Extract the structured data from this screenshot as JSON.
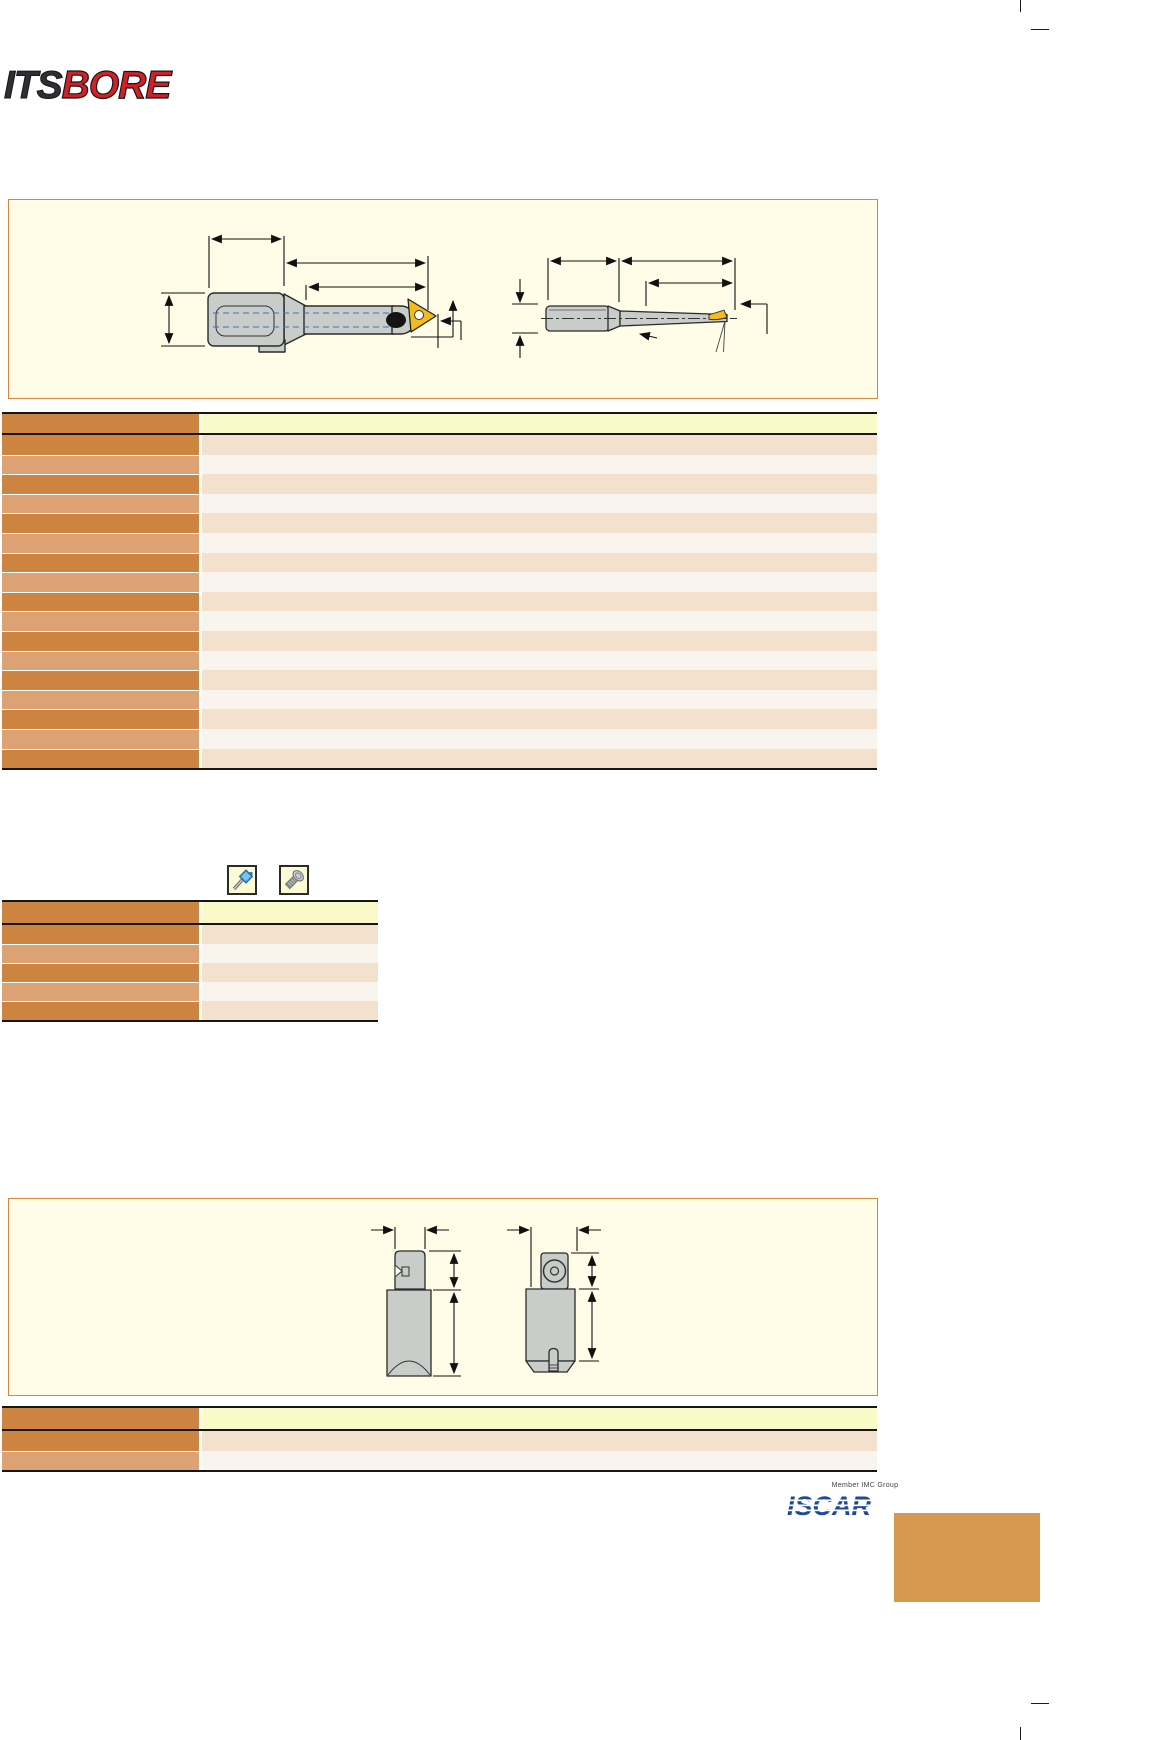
{
  "window": {
    "width": 1164,
    "height": 1740,
    "background": "#ffffff"
  },
  "logo": {
    "text_its": "ITS",
    "text_bore": "BORE",
    "color_its": "#2d2f34",
    "color_bore": "#d22027"
  },
  "diagram_box_1": {
    "background": "#fffde7",
    "border_color": "#d9863b",
    "drawings": [
      {
        "name": "boring-head-side-view"
      },
      {
        "name": "micro-boring-bar-side-view"
      }
    ],
    "steel_color": "#c9cdc9",
    "insert_color": "#f2bc1c",
    "centerline_color": "#3f6fbe"
  },
  "spec_table_1": {
    "columns": 2,
    "body_rows": 17,
    "header_left_color": "#cd8440",
    "header_right_color": "#faf9c8",
    "row_dark_color": "#cd8440",
    "row_light_color": "#dda273",
    "cell_dark_color": "#f3e1ce",
    "cell_light_color": "#faf4ee"
  },
  "mounting_icons": [
    {
      "name": "torx-key-icon",
      "background": "#fcfbd4"
    },
    {
      "name": "clamp-screw-icon",
      "background": "#fcfbd4"
    }
  ],
  "spec_table_2": {
    "columns": 2,
    "body_rows": 5
  },
  "diagram_box_2": {
    "background": "#fffde7",
    "border_color": "#d9863b",
    "drawings": [
      {
        "name": "cartridge-front-view"
      },
      {
        "name": "cartridge-side-view"
      }
    ]
  },
  "spec_table_3": {
    "columns": 2,
    "body_rows": 2
  },
  "footer": {
    "member_text": "Member IMC Group",
    "brand_text": "ISCAR",
    "brand_color": "#1b4a9e",
    "accent_block_color": "#d6994f"
  }
}
